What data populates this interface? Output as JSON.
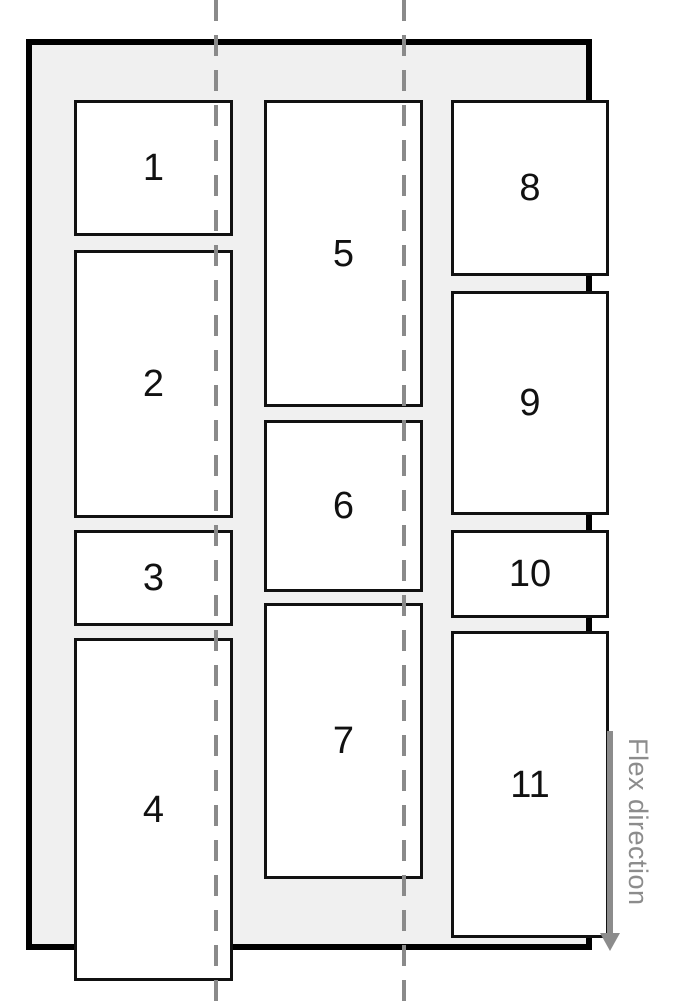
{
  "diagram": {
    "description": "flex-flow column wrap layout diagram",
    "items": [
      {
        "label": "1"
      },
      {
        "label": "2"
      },
      {
        "label": "3"
      },
      {
        "label": "4"
      },
      {
        "label": "5"
      },
      {
        "label": "6"
      },
      {
        "label": "7"
      },
      {
        "label": "8"
      },
      {
        "label": "9"
      },
      {
        "label": "10"
      },
      {
        "label": "11"
      }
    ],
    "columns": [
      {
        "item_labels": [
          "1",
          "2",
          "3",
          "4"
        ]
      },
      {
        "item_labels": [
          "5",
          "6",
          "7"
        ]
      },
      {
        "item_labels": [
          "8",
          "9",
          "10",
          "11"
        ]
      }
    ]
  },
  "annotation": {
    "flex_direction_label": "Flex direction"
  },
  "colors": {
    "page_bg": "#ffffff",
    "container_bg": "#f0f0f0",
    "border": "#000000",
    "box_bg": "#ffffff",
    "box_border": "#111111",
    "label_text": "#111111",
    "guide": "#8a8a8a",
    "annotation": "#8c8c8c"
  }
}
